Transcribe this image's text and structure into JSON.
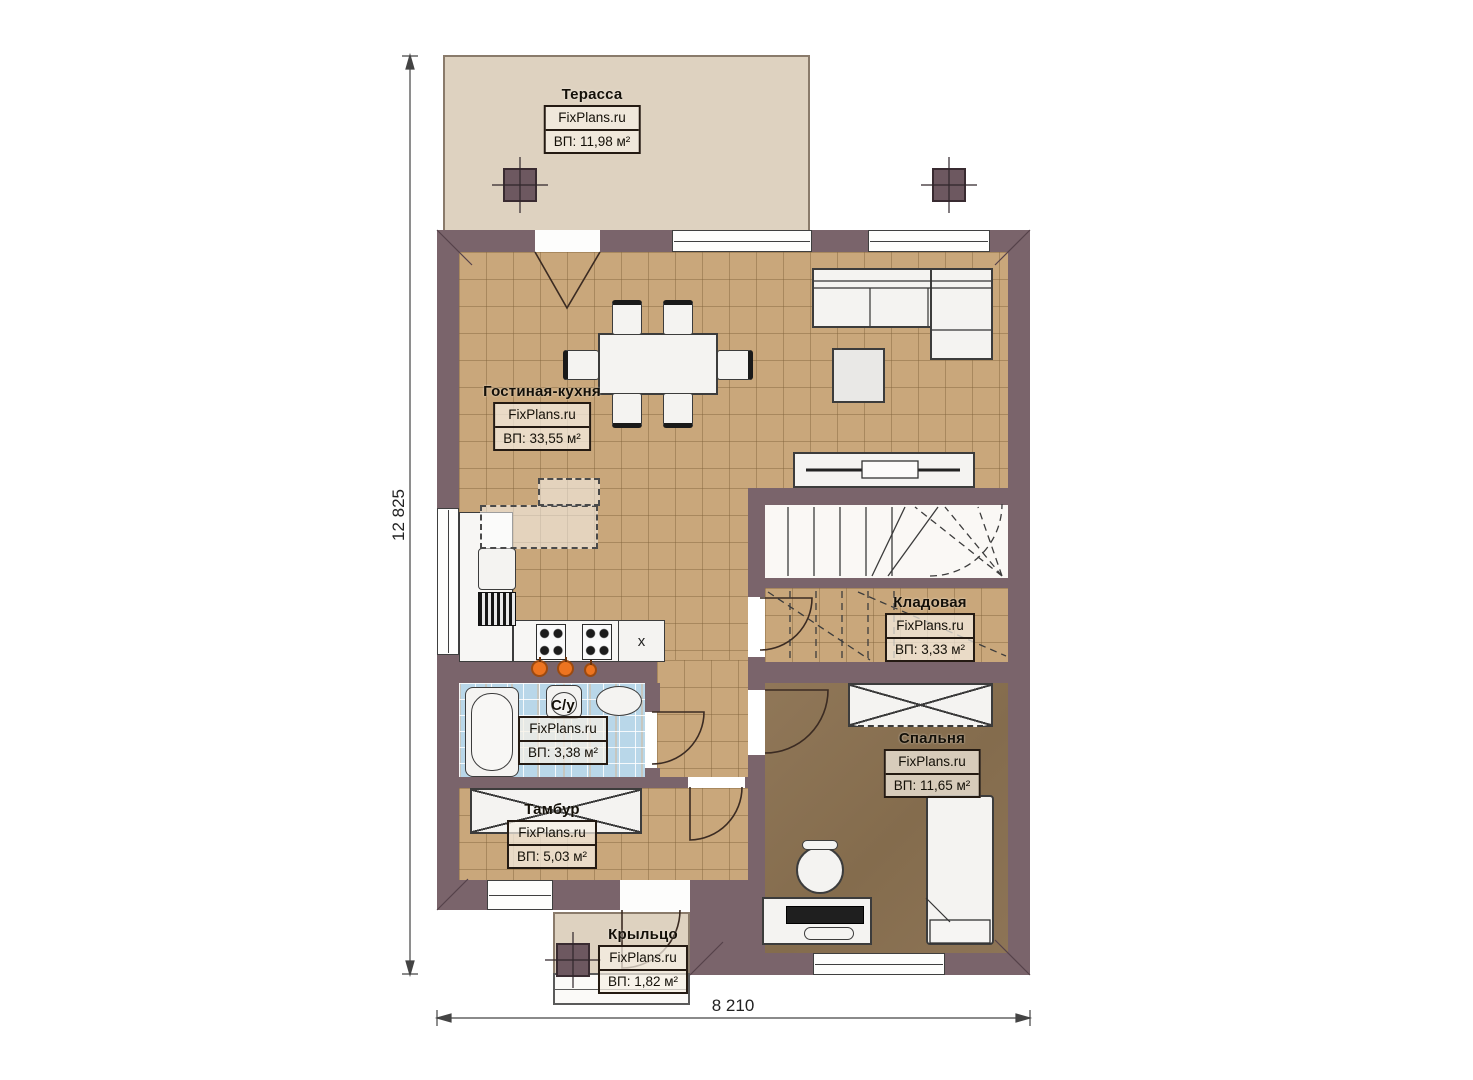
{
  "plan": {
    "watermark": "FixPlans.ru",
    "rooms": [
      {
        "name": "Терасса",
        "area": "ВП: 11,98 м²"
      },
      {
        "name": "Гостиная-кухня",
        "area": "ВП: 33,55 м²"
      },
      {
        "name": "Кладовая",
        "area": "ВП: 3,33 м²"
      },
      {
        "name": "С/у",
        "area": "ВП: 3,38 м²"
      },
      {
        "name": "Спальня",
        "area": "ВП: 11,65 м²"
      },
      {
        "name": "Тамбур",
        "area": "ВП: 5,03 м²"
      },
      {
        "name": "Крыльцо",
        "area": "ВП: 1,82 м²"
      }
    ],
    "dimensions": {
      "vertical": "12 825",
      "horizontal": "8 210"
    },
    "kitchen": {
      "fridge_mark": "x"
    },
    "colors": {
      "wall": "#7a646b",
      "tile_floor": "#c9a77b",
      "bath_floor": "#b9d7e9",
      "bedroom_floor": "#8b7254",
      "outdoor": "#ded2c0",
      "fixture_orange": "#ed7420"
    }
  }
}
